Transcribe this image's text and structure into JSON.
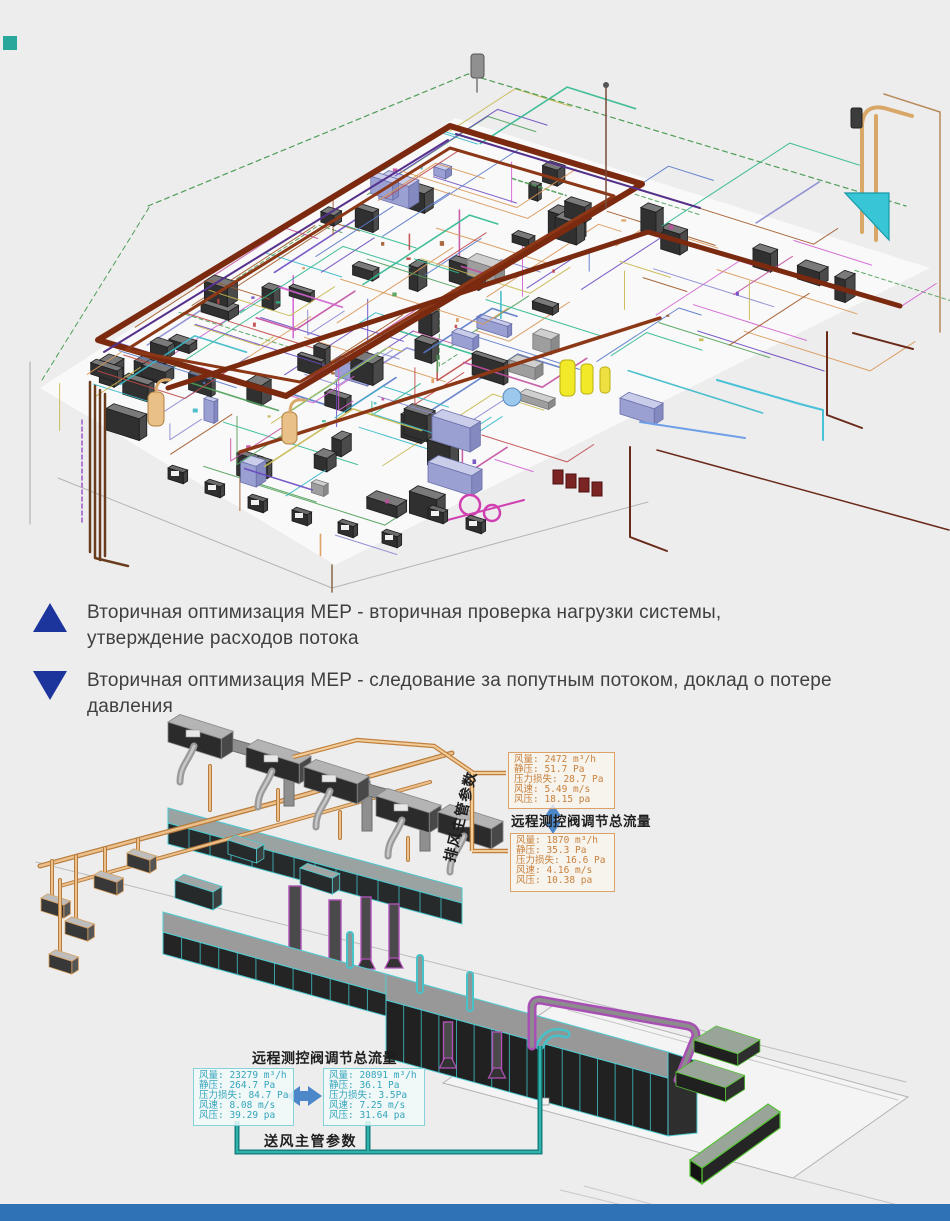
{
  "page": {
    "background": "#ededed",
    "bottom_bar_color": "#2f72b6",
    "corner_square_color": "#2aa79b"
  },
  "legend": {
    "marker_color": "#1c359c",
    "items": [
      {
        "icon": "up-triangle",
        "text": "Вторичная  оптимизация  MEP - вторичная проверка нагрузки системы,\nутверждение расходов потока"
      },
      {
        "icon": "down-triangle",
        "text": "Вторичная оптимизация MEP - следование за попутным потоком, доклад о потере\nдавления"
      }
    ]
  },
  "models": {
    "top": {
      "description": "MEP BIM isometric overview model"
    },
    "bottom": {
      "description": "Duct system model with flow measurement annotations"
    }
  },
  "exhaust_annotation": {
    "duct_label": "排风主管参数",
    "valve_label": "远程测控阀调节总流量",
    "box_top": {
      "lines": [
        "风量: 2472 m³/h",
        "静压: 51.7 Pa",
        "压力损失: 28.7 Pa",
        "风速: 5.49 m/s",
        "风压: 18.15 pa"
      ]
    },
    "box_bottom": {
      "lines": [
        "风量: 1870 m³/h",
        "静压: 35.3 Pa",
        "压力损失: 16.6 Pa",
        "风速: 4.16 m/s",
        "风压: 10.38 pa"
      ]
    }
  },
  "supply_annotation": {
    "valve_label": "远程测控阀调节总流量",
    "duct_label": "送风主管参数",
    "box_left": {
      "lines": [
        "风量: 23279 m³/h",
        "静压: 264.7 Pa",
        "压力损失: 84.7 Pa",
        "风速: 8.08 m/s",
        "风压: 39.29 pa"
      ]
    },
    "box_right": {
      "lines": [
        "风量: 20891 m³/h",
        "静压: 36.1 Pa",
        "压力损失: 3.5Pa",
        "风速: 7.25 m/s",
        "风压: 31.64 pa"
      ]
    }
  },
  "colors": {
    "arrow_blue": "#4c87c9",
    "leader_orange": "#c08040",
    "leader_teal": "#167d7d",
    "exhaust_accent": "#dda269",
    "supply_accent": "#86d2da"
  }
}
